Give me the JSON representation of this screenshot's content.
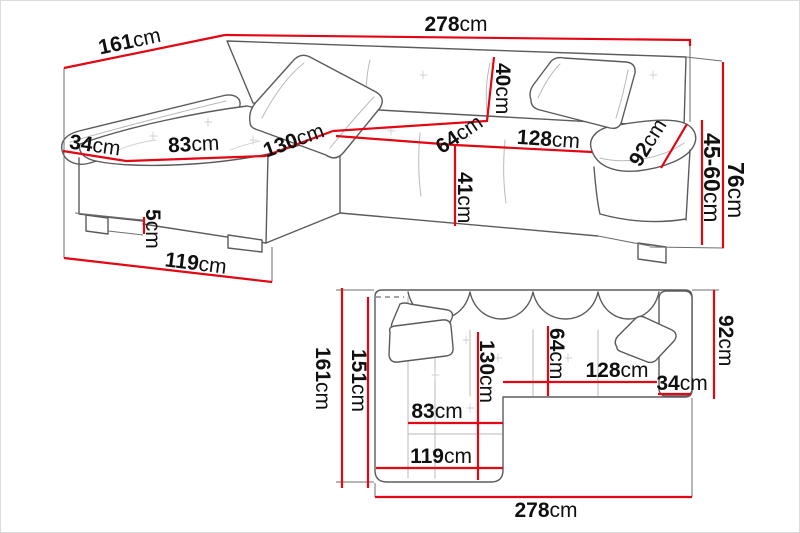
{
  "diagram": {
    "subject": "corner-sofa-dimension-diagram",
    "unit": "cm",
    "colors": {
      "dimension_line": "#e30613",
      "outline": "#5a5b5e",
      "seam": "#b9babd",
      "background": "#ffffff",
      "text": "#101010"
    }
  },
  "perspective_view": {
    "total_length": {
      "num": "278",
      "unit": "cm"
    },
    "chaise_depth": {
      "num": "161",
      "unit": "cm"
    },
    "back_height": {
      "num": "40",
      "unit": "cm"
    },
    "seat_depth": {
      "num": "64",
      "unit": "cm"
    },
    "seat_length": {
      "num": "128",
      "unit": "cm"
    },
    "armrest_length": {
      "num": "92",
      "unit": "cm"
    },
    "total_height": {
      "num": "76",
      "unit": "cm"
    },
    "armrest_height": {
      "num": "45-60",
      "unit": "cm"
    },
    "seat_height": {
      "num": "41",
      "unit": "cm"
    },
    "armrest_width": {
      "num": "34",
      "unit": "cm"
    },
    "chaise_seat_width": {
      "num": "83",
      "unit": "cm"
    },
    "chaise_length": {
      "num": "130",
      "unit": "cm"
    },
    "leg_height": {
      "num": "5",
      "unit": "cm"
    },
    "chaise_front_width": {
      "num": "119",
      "unit": "cm"
    }
  },
  "top_view": {
    "chaise_depth": {
      "num": "161",
      "unit": "cm"
    },
    "bed_length": {
      "num": "151",
      "unit": "cm"
    },
    "body_depth": {
      "num": "92",
      "unit": "cm"
    },
    "seat_depth": {
      "num": "64",
      "unit": "cm"
    },
    "chaise_length": {
      "num": "130",
      "unit": "cm"
    },
    "seat_length": {
      "num": "128",
      "unit": "cm"
    },
    "armrest_width": {
      "num": "34",
      "unit": "cm"
    },
    "chaise_seat_width": {
      "num": "83",
      "unit": "cm"
    },
    "chaise_front_width": {
      "num": "119",
      "unit": "cm"
    },
    "total_length": {
      "num": "278",
      "unit": "cm"
    }
  }
}
